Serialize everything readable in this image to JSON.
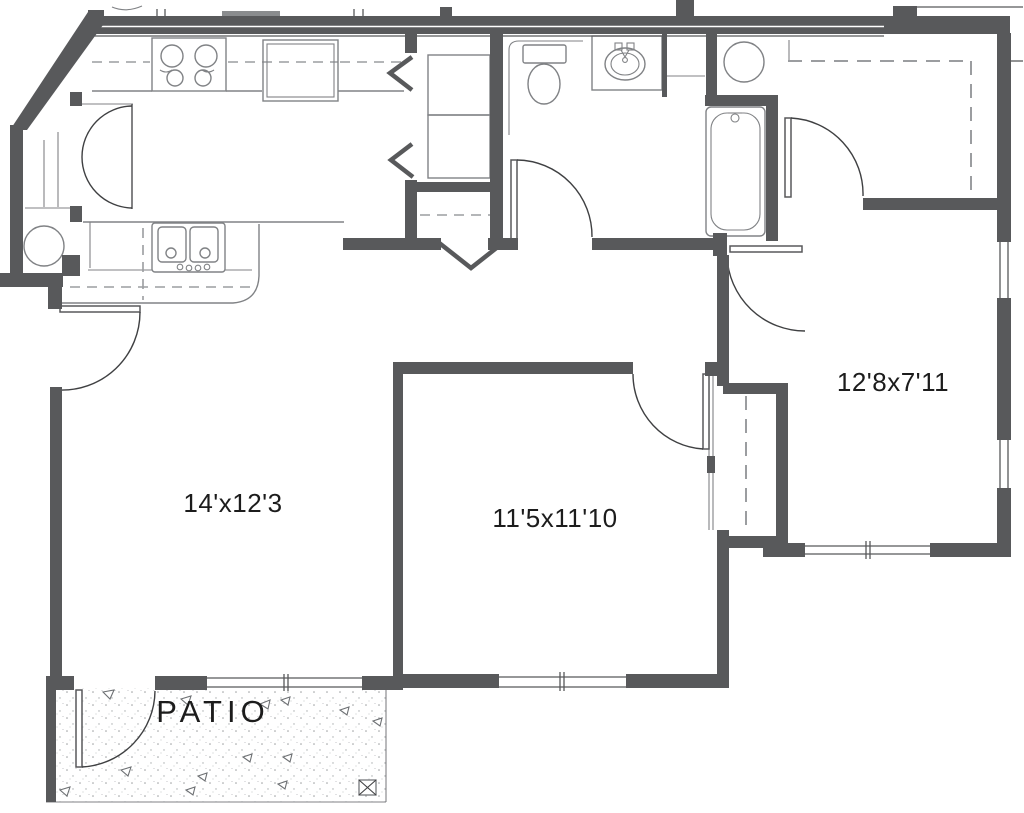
{
  "plan": {
    "type": "apartment-floor-plan",
    "rooms": {
      "living": {
        "label": "14'x12'3"
      },
      "bedroom1": {
        "label": "11'5x11'10"
      },
      "bedroom2": {
        "label": "12'8x7'11"
      },
      "patio": {
        "label": "PATIO"
      }
    },
    "colors": {
      "wall": "#58595b",
      "fixture": "#808285",
      "dashed": "#9b9da0",
      "arc": "#3f4042",
      "stipple": "#9b9ea0",
      "text": "#1c1c1c"
    }
  }
}
